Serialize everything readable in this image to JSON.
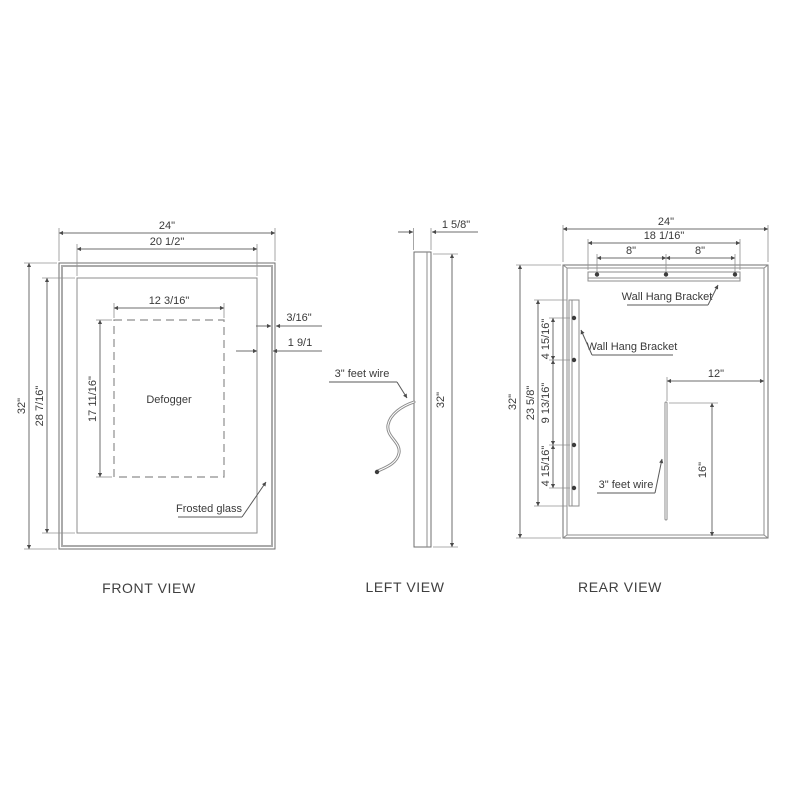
{
  "views": {
    "front": {
      "label": "FRONT VIEW",
      "dims": {
        "width": "24\"",
        "glass_width": "20 1/2\"",
        "defogger_width": "12 3/16\"",
        "height": "32\"",
        "glass_height": "28 7/16\"",
        "defogger_height": "17 11/16\"",
        "glass_thickness": "3/16\"",
        "frame_width": "1 9/1"
      },
      "annotations": {
        "defogger": "Defogger",
        "frosted_glass": "Frosted glass"
      }
    },
    "left": {
      "label": "LEFT VIEW",
      "dims": {
        "depth": "1 5/8\"",
        "height": "32\""
      },
      "annotations": {
        "wire": "3\" feet wire"
      }
    },
    "rear": {
      "label": "REAR VIEW",
      "dims": {
        "width": "24\"",
        "bracket_width": "18 1/16\"",
        "hole_span_left": "8\"",
        "hole_span_right": "8\"",
        "height": "32\"",
        "bracket_height": "23 5/8\"",
        "seg_top": "4 15/16\"",
        "seg_mid": "9 13/16\"",
        "seg_bottom": "4 15/16\"",
        "wire_offset": "12\"",
        "wire_drop": "16\""
      },
      "annotations": {
        "bracket_top": "Wall Hang Bracket",
        "bracket_left": "Wall Hang Bracket",
        "wire": "3\" feet wire"
      }
    }
  },
  "colors": {
    "line": "#8e8e8e",
    "dim_line": "#6e6e6e",
    "text": "#3a3a3a"
  }
}
